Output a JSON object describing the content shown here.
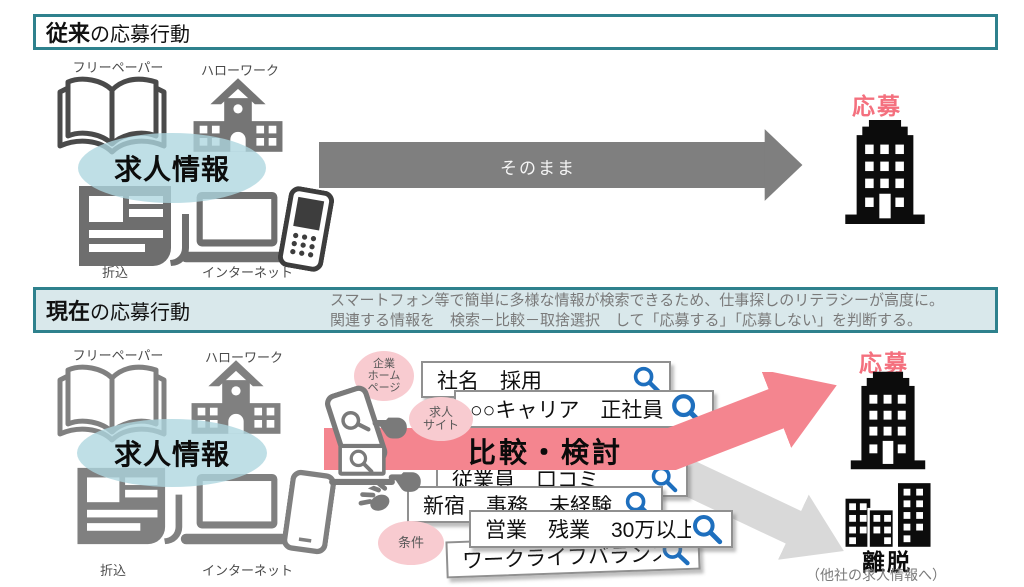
{
  "colors": {
    "teal_border": "#2E818D",
    "header_fill": "#D9E8EB",
    "pink_arrow": "#F4858F",
    "pink_text": "#F4707E",
    "pink_circle": "#F8CBD0",
    "dark_arrow": "#7F7F7F",
    "light_arrow": "#D9D9D9",
    "magnifier_blue": "#1E6FBE",
    "box_border": "#909090",
    "building_black": "#0C0C0C",
    "label_gray": "#4A4A4A",
    "note_gray": "#7A7A7A"
  },
  "section_traditional": {
    "title_bold": "従来",
    "title_rest": "の応募行動",
    "sources": {
      "free_paper": "フリーペーパー",
      "hello_work": "ハローワーク",
      "insert": "折込",
      "internet": "インターネット"
    },
    "info_label": "求人情報",
    "arrow_label": "そのまま",
    "apply_label": "応募"
  },
  "section_current": {
    "title_bold": "現在",
    "title_rest": "の応募行動",
    "description_line1": "スマートフォン等で簡単に多様な情報が検索できるため、仕事探しのリテラシーが高度に。",
    "description_line2": "関連する情報を　検索－比較－取捨選択　して「応募する」「応募しない」を判断する。",
    "sources": {
      "free_paper": "フリーペーパー",
      "hello_work": "ハローワーク",
      "insert": "折込",
      "internet": "インターネット"
    },
    "info_label": "求人情報",
    "bubbles": [
      {
        "line1": "企業",
        "line2": "ホーム",
        "line3": "ページ"
      },
      {
        "line1": "求人",
        "line2": "サイト"
      },
      {
        "line1": "条件"
      }
    ],
    "search_boxes": [
      {
        "query": "社名　採用"
      },
      {
        "query": "○○キャリア　正社員"
      },
      {
        "query": "従業員　口コミ"
      },
      {
        "query": "新宿　事務　未経験"
      },
      {
        "query": "営業　残業　30万以上"
      },
      {
        "query": "ワークライフバランス"
      }
    ],
    "compare_label": "比較・検討",
    "apply_label": "応募",
    "leave_label": "離脱",
    "leave_note": "（他社の求人情報へ）"
  }
}
